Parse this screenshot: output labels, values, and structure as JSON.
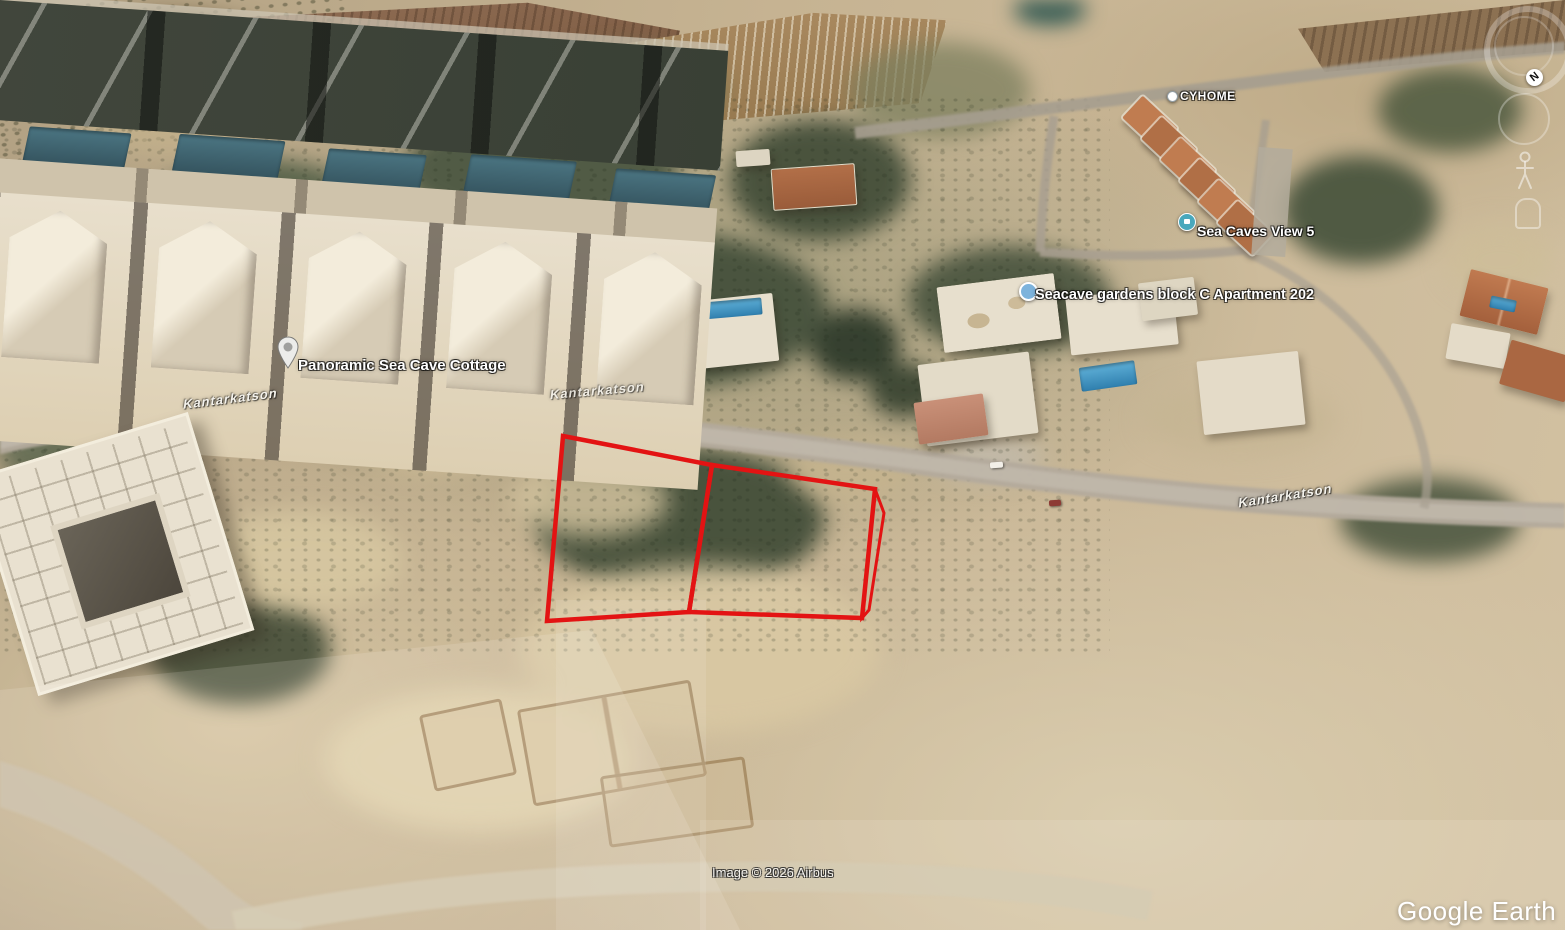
{
  "app": {
    "logo_text": "Google Earth"
  },
  "attribution": {
    "imagery": "Image © 2026 Airbus"
  },
  "compass": {
    "north_label": "N"
  },
  "map": {
    "place_labels": [
      {
        "id": "cyhome",
        "text": "CYHOME",
        "marker": "poi-dot-marker"
      },
      {
        "id": "sea-caves-view-5",
        "text": "Sea Caves View 5",
        "marker": "lodging-marker"
      },
      {
        "id": "seacave-gardens-block-c-apartment-202",
        "text": "Seacave gardens block C Apartment 202",
        "marker": "poi-dot-marker"
      },
      {
        "id": "panoramic-sea-cave-cottage",
        "text": "Panoramic Sea Cave Cottage",
        "marker": "pin-marker"
      }
    ],
    "road_labels": [
      {
        "id": "kantarkatson-west",
        "text": "Kantarkatson"
      },
      {
        "id": "kantarkatson-center",
        "text": "Kantarkatson"
      },
      {
        "id": "kantarkatson-east",
        "text": "Kantarkatson"
      }
    ],
    "overlay": {
      "description": "red property plot outline, two adjacent plots with narrow sliver on east edge",
      "plot_count": 2,
      "outline_color": "#e31313"
    }
  },
  "colors": {
    "plot_outline": "#e31313",
    "pool_blue": "#3f8fc0",
    "pool_dark_teal": "#3a616d",
    "roof_orange": "#b5714a",
    "road_gray": "#b3aa9c",
    "label_text": "#ffffff"
  }
}
